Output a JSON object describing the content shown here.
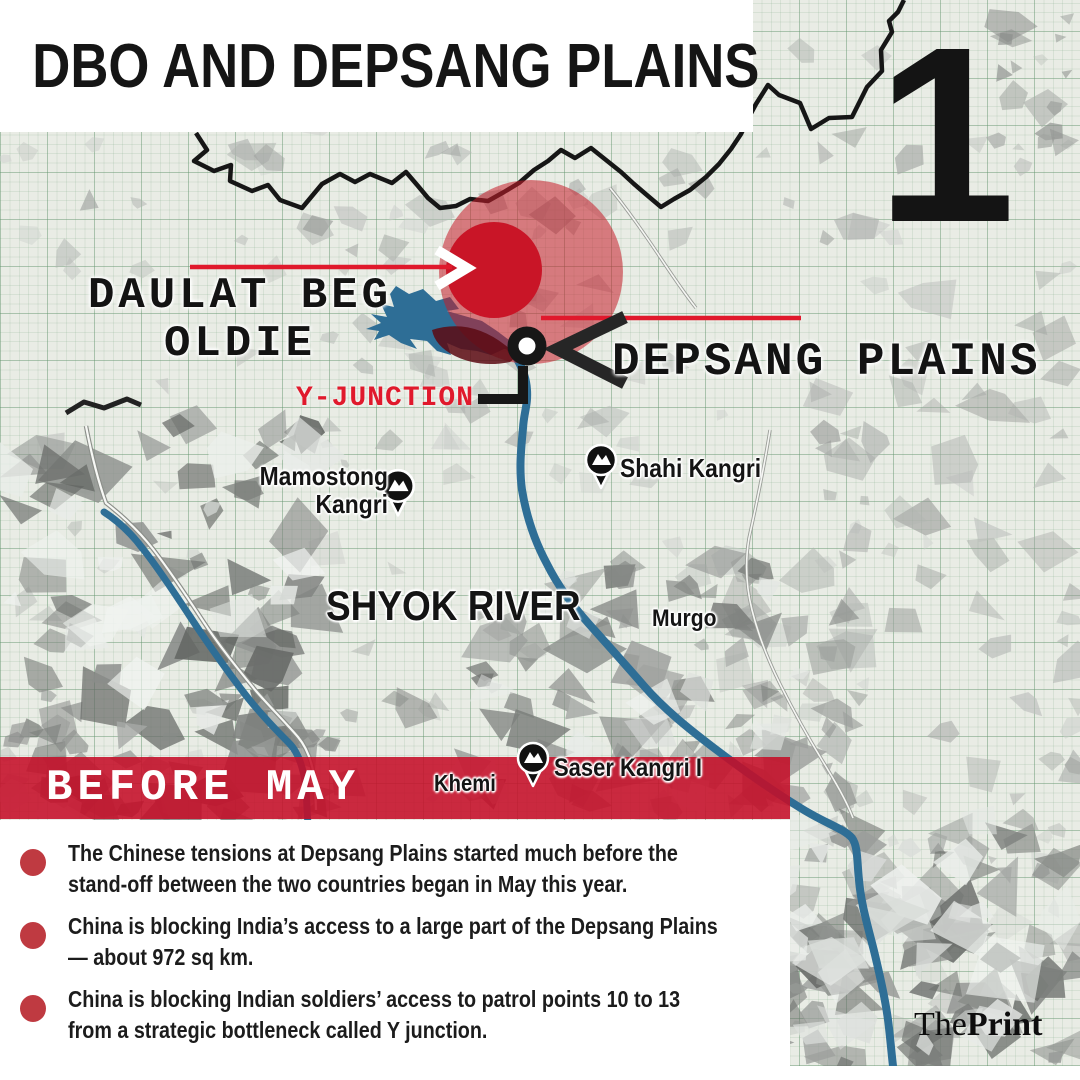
{
  "title": "DBO AND DEPSANG PLAINS",
  "slide_number": "1",
  "map_labels": {
    "daulat_beg_oldie_line1": "DAULAT BEG",
    "daulat_beg_oldie_line2": "OLDIE",
    "depsang_plains": "DEPSANG PLAINS",
    "y_junction": "Y-JUNCTION",
    "mamostong_line1": "Mamostong",
    "mamostong_line2": "Kangri",
    "shahi_kangri": "Shahi Kangri",
    "shyok_river": "SHYOK RIVER",
    "murgo": "Murgo",
    "khemi": "Khemi",
    "saser_kangri": "Saser Kangri I"
  },
  "banner": {
    "label": "BEFORE MAY"
  },
  "bullets": [
    {
      "line1": "The Chinese tensions at Depsang Plains started much before the",
      "line2": "stand-off between the two countries began in May this year."
    },
    {
      "line1": "China is blocking India’s access to a large part of the Depsang Plains",
      "line2": "— about 972 sq km."
    },
    {
      "line1": "China is blocking Indian soldiers’ access to patrol points 10 to 13",
      "line2": "from a strategic bottleneck called Y junction."
    }
  ],
  "logo": {
    "part1": "The",
    "part2": "Print"
  },
  "colors": {
    "accent_red": "#e0192c",
    "banner_red": "rgba(197,14,40,0.88)",
    "bullet_red": "#bf3a41",
    "highlight_outer": "rgba(198,30,42,0.55)",
    "highlight_inner": "#c91527",
    "river_blue": "#2e6e96"
  }
}
